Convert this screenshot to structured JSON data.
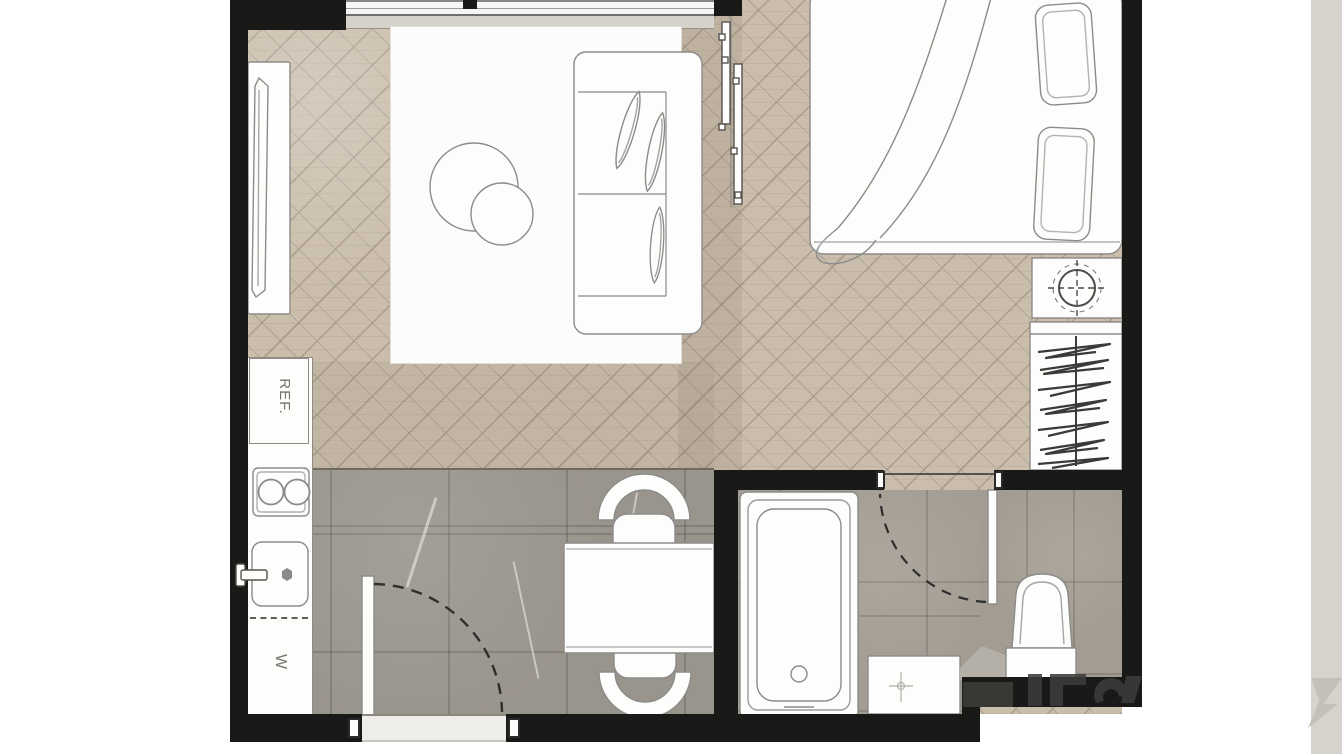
{
  "canvas": {
    "width": 1342,
    "height": 754,
    "background": "#ffffff"
  },
  "palette": {
    "page": "#ffffff",
    "wall": "#191917",
    "wood": "#cabdab",
    "tile-dining": "#99948c",
    "tile-bath": "#a39c92",
    "fixture-fill": "#fdfdfb",
    "fixture-stroke": "#8b8b89",
    "sill": "#d5d2cb",
    "margin-band": "#d7d3cc",
    "watermark-dark": "#3c3c3a",
    "watermark-light": "#c4c0b9"
  },
  "labels": {
    "refrigerator": "REF.",
    "washer": "W"
  }
}
